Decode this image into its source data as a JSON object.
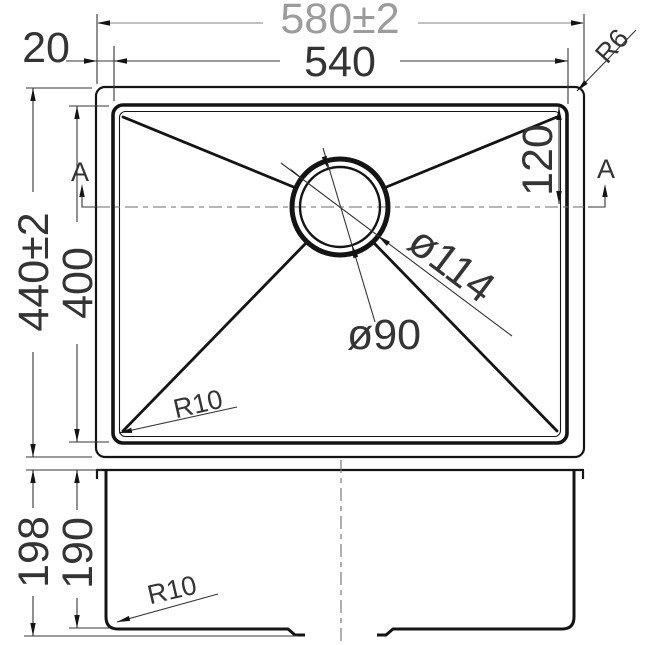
{
  "drawing": {
    "type": "technical-dimension-drawing",
    "subject": "single-bowl-sink",
    "colors": {
      "background": "#ffffff",
      "line": "#141414",
      "dimension": "#343434",
      "muted_dimension": "#9c9c9c"
    },
    "top_view": {
      "labels": {
        "overall_width": "580±2",
        "opening_width": "540",
        "rim_offset": "20",
        "overall_depth": "440±2",
        "opening_depth": "400",
        "drain_center_offset": "120",
        "outer_corner_radius": "R6",
        "opening_corner_radius": "R10",
        "drain_flange_diameter": "ø114",
        "drain_hole_diameter": "ø90",
        "section_marker_left": "A",
        "section_marker_right": "A"
      }
    },
    "side_view": {
      "labels": {
        "total_depth": "198",
        "bowl_depth": "190",
        "bottom_corner_radius": "R10"
      }
    }
  }
}
